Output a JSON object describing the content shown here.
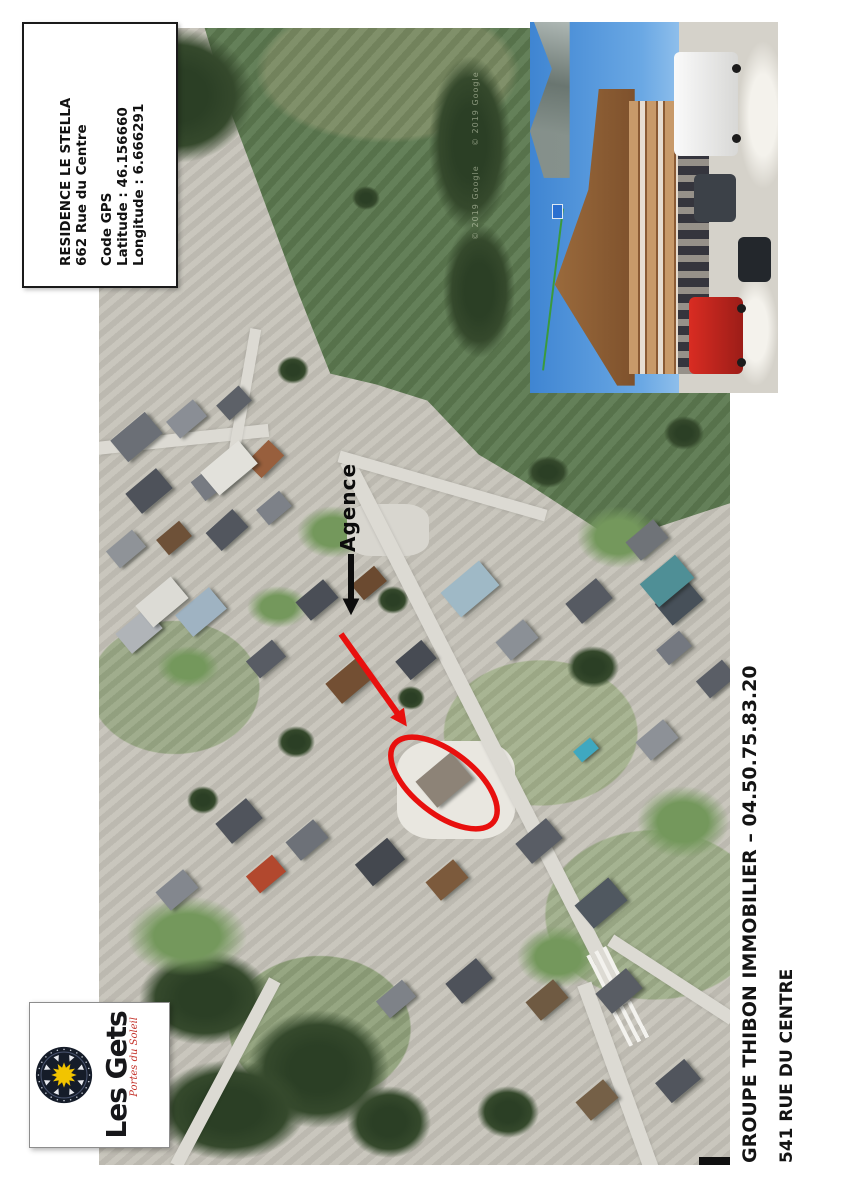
{
  "info_box": {
    "lines": [
      "RESIDENCE LE STELLA",
      "662 Rue du Centre",
      "",
      "Code GPS",
      "Latitude : 46.156660",
      "Longitude : 6.666291"
    ]
  },
  "map": {
    "agence_label": "Agence",
    "watermark": "© 2019 Google"
  },
  "logo": {
    "name": "Les Gets",
    "tagline": "Portes du Soleil"
  },
  "footer": {
    "agency_line": "GROUPE THIBON IMMOBILIER – 04.50.75.83.20",
    "address_line": "541 RUE DU CENTRE"
  },
  "colors": {
    "annotation_red": "#e8100e",
    "arrow_black": "#0d0d0d",
    "logo_sun_yellow": "#f2c400",
    "logo_red": "#c5342c",
    "field_green": "#5c7950"
  }
}
